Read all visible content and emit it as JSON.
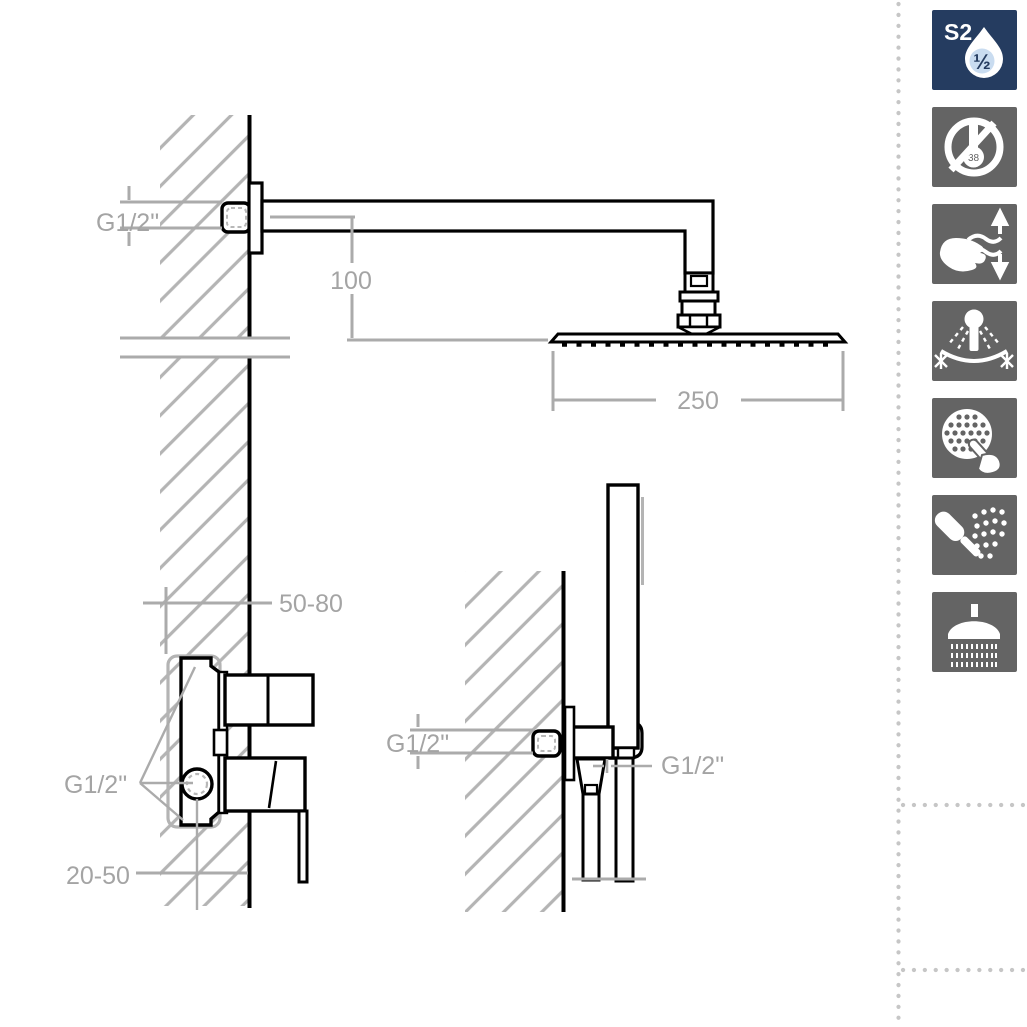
{
  "diagram": {
    "title_hint": "shower-set-installation-drawing",
    "dimension_labels": {
      "arm_supply_thread": "G1/2\"",
      "arm_drop_height": "100",
      "head_width": "250",
      "valve_rough_in_depth": "50-80",
      "valve_connections_thread": "G1/2\"",
      "valve_center_depth": "20-50",
      "outlet_supply_thread": "G1/2\"",
      "hose_connection_thread": "G1/2\""
    },
    "colors": {
      "drawing_line": "#000000",
      "dimension_gray": "#ababab",
      "label_gray": "#a4a4a4",
      "hatch_gray": "#b4b4b4",
      "dotted_border": "#c6c6c6"
    }
  },
  "sidebar": {
    "badge": {
      "code": "S2",
      "fraction": "½",
      "color": "#253c60"
    },
    "tile_color": "#646464",
    "thermometer_value": "38",
    "icons": [
      "s2-half-inch-badge",
      "no-thermostat-38-icon",
      "flow-adjust-hand-icon",
      "swivel-head-antifreeze-icon",
      "easy-clean-nozzles-icon",
      "handshower-spray-icon",
      "rain-shower-icon"
    ]
  }
}
